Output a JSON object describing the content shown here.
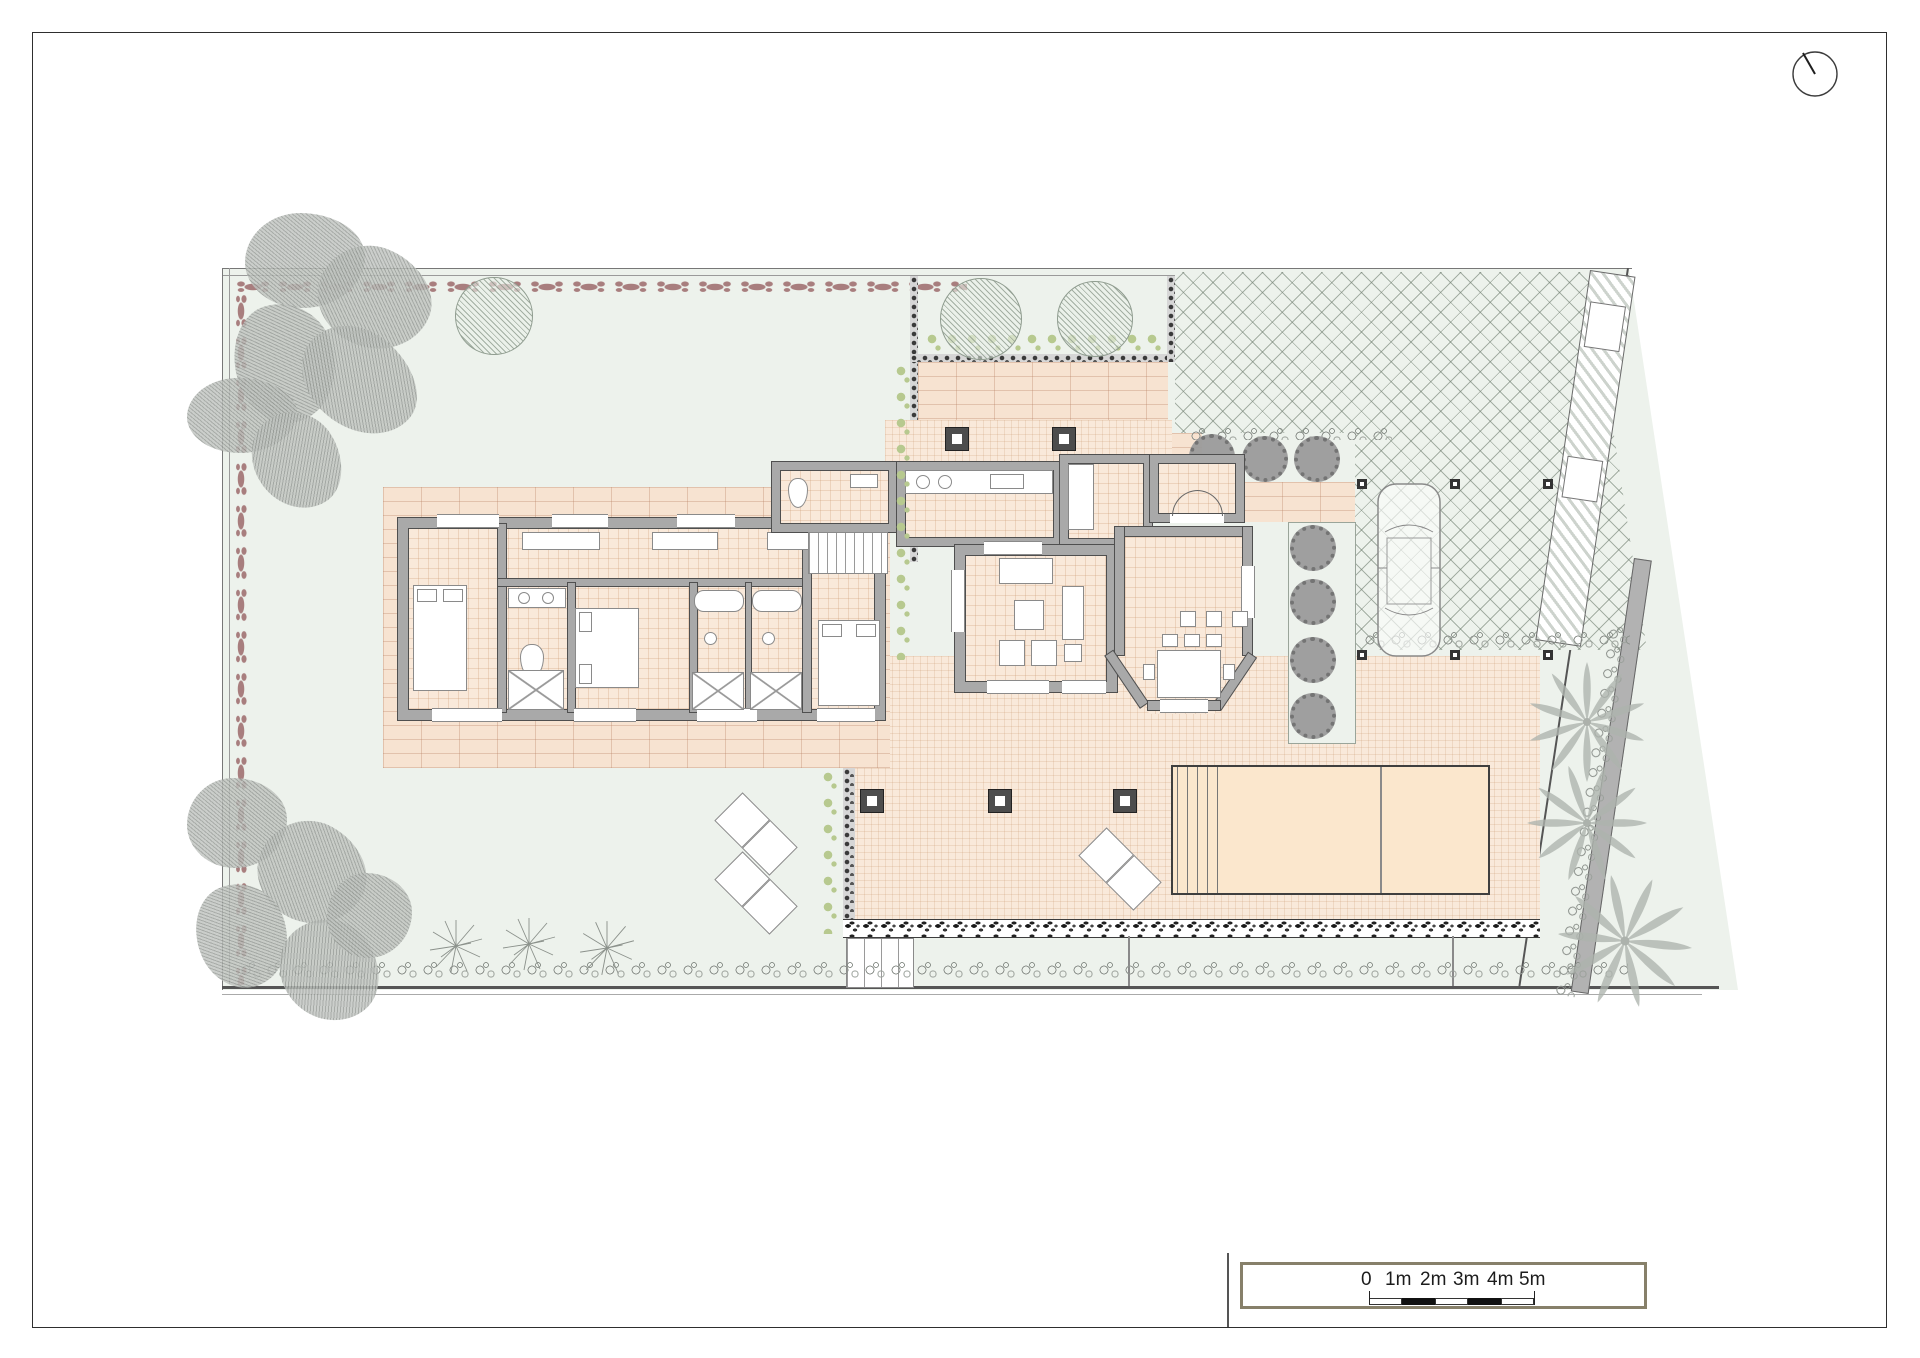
{
  "document": {
    "type": "architectural-site-plan-ground-floor",
    "visible_text_note": "only scale bar labels are rendered text"
  },
  "scale_bar": {
    "labels": [
      "0",
      "1m",
      "2m",
      "3m",
      "4m",
      "5m"
    ],
    "segments": [
      "white",
      "black",
      "white",
      "black",
      "white"
    ]
  },
  "compass": {
    "icon": "north-indicator-icon"
  },
  "palette": {
    "paper": "#ffffff",
    "lawn": "#edf2ec",
    "tile": "#f9e9da",
    "brick": "#f7e3d1",
    "pool": "#fbe7cd",
    "wall": "#a9a9a9",
    "walledge": "#4f4f4f",
    "hedge": "#a87e7e",
    "olive": "#b7c98f"
  }
}
